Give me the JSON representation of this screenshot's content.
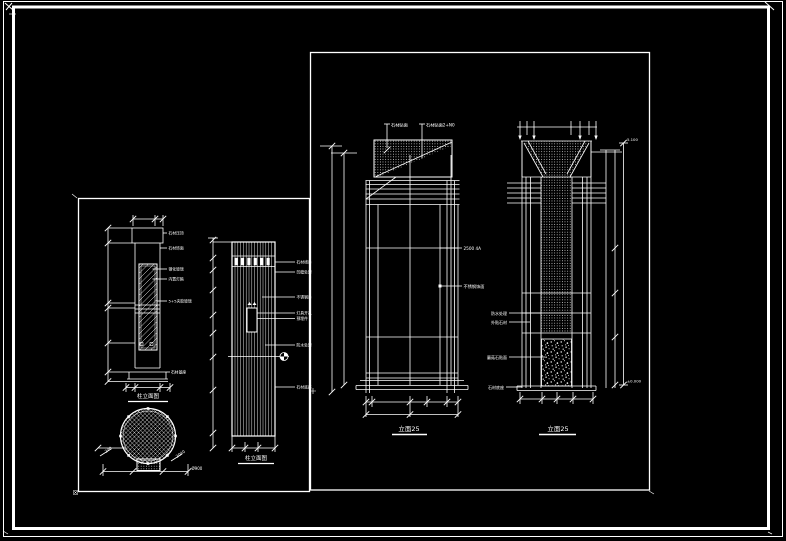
{
  "canvas": {
    "bg": "#000000",
    "line_color": "#ffffff"
  },
  "right_panel": {
    "col1": {
      "top_labels": [
        "石材贴面",
        "石材贴面2+N0"
      ],
      "side_labels": [
        "2500 4A",
        "不锈钢饰面"
      ],
      "caption": "立面25"
    },
    "col2": {
      "left_labels": [
        "防水处理",
        "外贴石材",
        "蘑菇石贴面",
        "石材底座"
      ],
      "elev_top": "5.100",
      "elev_bottom": "±0.000",
      "caption": "立面25"
    }
  },
  "left_panel": {
    "elev1": {
      "right_labels": [
        "石材压顶",
        "石材饰面",
        "钢化玻璃",
        "内置灯箱",
        "5+5夹胶玻璃",
        "石材基座"
      ],
      "caption": "柱立面图"
    },
    "plan": {
      "dim_right": "Ø900",
      "dim_rot_left": "240",
      "dim_rot_right": "2040"
    },
    "elev2": {
      "right_labels": [
        "石材线条",
        "凹缝处理",
        "不锈钢条",
        "灯具开孔",
        "预埋件",
        "防水处理",
        "石材底座"
      ],
      "caption": "柱立面图"
    }
  }
}
